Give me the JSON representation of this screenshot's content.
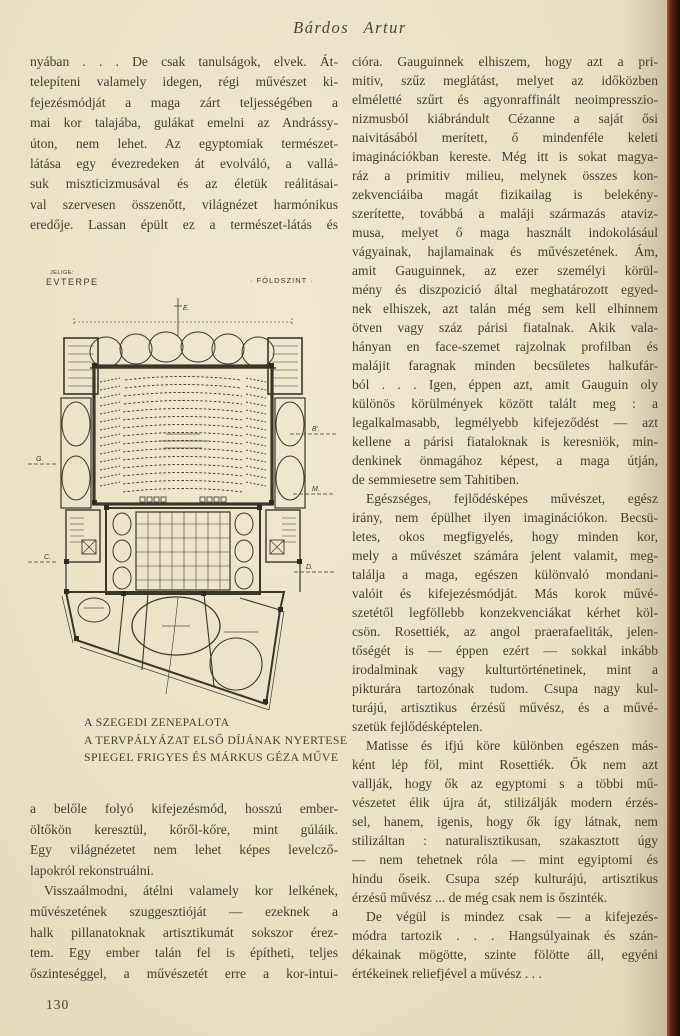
{
  "page": {
    "header_title": "Bárdos Artur",
    "page_number": "130",
    "paper_color": "#eae1c6",
    "ink_color": "#413d30",
    "edge_color": "#552012"
  },
  "left_column": {
    "top": {
      "open_end": true,
      "paragraphs": [
        [
          "nyában . . .  De csak tanulságok, elvek. Át-",
          "telepíteni valamely idegen, régi művészet ki-",
          "fejezésmódját a maga zárt teljességében a",
          "mai kor talajába, gulákat emelni az Andrássy-",
          "úton, nem lehet. Az egyptomiak természet-",
          "látása egy évezredeken át evolváló, a vallá-",
          "suk miszticizmusával és az életük reálitásai-",
          "val szervesen összenőtt, világnézet harmónikus",
          "eredője. Lassan épült ez a természet-látás és"
        ]
      ]
    },
    "bottom": {
      "open_end": true,
      "paragraphs": [
        [
          "a belőle folyó kifejezésmód, hosszú ember-",
          "öltőkön keresztül, kőről-kőre, mint gúláik.",
          "Egy világnézetet nem lehet képes levelcző-",
          "lapokról rekonstruálni."
        ],
        [
          "Visszaálmodni, átélni valamely kor lelkének,",
          "művészetének szuggesztióját — ezeknek a",
          "halk pillanatoknak artisztikumát sokszor érez-",
          "tem. Egy ember talán fel is építheti, teljes",
          "őszinteséggel, a művészetét erre a kor-intui-"
        ]
      ]
    }
  },
  "right_column": {
    "open_end": false,
    "paragraphs": [
      [
        "cióra. Gauguinnek elhiszem, hogy azt a pri-",
        "mitiv, szűz meglátást, melyet az időközben",
        "elméletté szűrt és agyonraffinált neoimpresszio-",
        "nizmusból kiábrándult Cézanne a saját ősi",
        "naivitásából merített, ő mindenféle keleti",
        "imaginációkban kereste. Még itt is sokat magya-",
        "ráz a primitiv milieu, melynek összes kon-",
        "zekvenciáiba magát fizikailag is belekény-",
        "szerítette, továbbá a maláji származás ataviz-",
        "musa, melyet ő maga használt indokolásául",
        "vágyainak, hajlamainak és művészetének. Ám,",
        "amit Gauguinnek, az ezer személyi körül-",
        "mény és diszpozició által meghatározott egyed-",
        "nek elhiszek, azt talán még sem kell elhinnem",
        "ötven vagy száz párisi fiatalnak. Akik vala-",
        "hányan en face-szemet rajzolnak profilban és",
        "malájit faragnak minden becsületes halkufár-",
        "ból . . . Igen, éppen azt, amit Gauguin oly",
        "különös körülmények között talált meg : a",
        "legalkalmasabb, legmélyebb kifejeződést — azt",
        "kellene a párisi fiataloknak is keresniök, min-",
        "denkinek önmagához képest, a maga útján,",
        "de semmiesetre sem Tahitiben."
      ],
      [
        "Egészséges, fejlődésképes művészet, egész",
        "irány, nem épülhet ilyen imaginációkon. Becsü-",
        "letes, okos megfigyelés, hogy minden kor,",
        "mely a művészet számára jelent valamit, meg-",
        "találja a maga, egészen különvaló mondani-",
        "valóit és kifejezésmódját. Más korok művé-",
        "szetétől legföllebb konzekvenciákat kérhet köl-",
        "csön. Rosettiék, az angol praerafaeliták, jelen-",
        "tőségét is — éppen ezért — sokkal inkább",
        "irodalminak vagy kulturtörténetinek, mint a",
        "pikturára tartozónak tudom. Csupa nagy kul-",
        "turájú, artisztikus érzésű művész, és a művé-",
        "szetük fejlődésképtelen."
      ],
      [
        "Matisse és ifjú köre különben egészen más-",
        "ként lép föl, mint Rosettiék. Ők nem azt",
        "vallják, hogy ők az egyptomi s a többi mű-",
        "vészetet élik újra át, stilizálják modern érzés-",
        "sel, hanem, igenis, hogy ők így látnak, nem",
        "stilizáltan : naturalisztikusan, szakasztott úgy",
        "— nem tehetnek róla — mint egyiptomi és",
        "hindu őseik. Csupa szép kulturájú, artisztikus",
        "érzésű művész ... de még csak nem is őszinték."
      ],
      [
        "De végül is mindez csak — a kifejezés-",
        "módra tartozik . . . Hangsúlyainak és szán-",
        "dékainak mögötte, szinte fölötte áll, egyéni",
        "értékeinek reliefjével a művész . . ."
      ]
    ]
  },
  "figure": {
    "jelige_label": "JELIGE:",
    "motto": "EVTERPE",
    "floor_label": "· FÖLDSZINT ·",
    "section_marks": {
      "e": "E.",
      "b": "B'.",
      "g": "G.",
      "c": "C.",
      "d": "D.",
      "m": "M."
    },
    "caption": [
      "A SZEGEDI ZENEPALOTA",
      "A TERVPÁLYÁZAT ELSŐ DÍJÁNAK NYERTESE",
      "SPIEGEL FRIGYES ÉS MÁRKUS GÉZA MŰVE"
    ]
  }
}
